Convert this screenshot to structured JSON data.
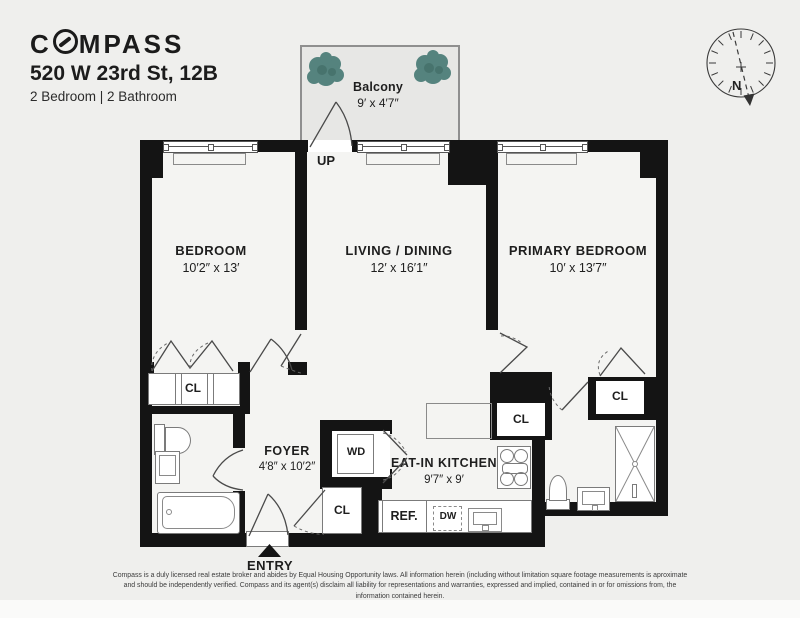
{
  "header": {
    "logo_c": "C",
    "logo_rest": "MPASS",
    "address": "520 W 23rd St, 12B",
    "subtitle": "2 Bedroom | 2 Bathroom"
  },
  "compass_rose": {
    "north_label": "N"
  },
  "rooms": {
    "balcony": {
      "name": "Balcony",
      "dims": "9′ x 4′7″"
    },
    "bedroom": {
      "name": "BEDROOM",
      "dims": "10′2″ x 13′"
    },
    "living": {
      "name": "LIVING / DINING",
      "dims": "12′ x 16′1″"
    },
    "primary": {
      "name": "PRIMARY BEDROOM",
      "dims": "10′ x 13′7″"
    },
    "foyer": {
      "name": "FOYER",
      "dims": "4′8″ x 10′2″"
    },
    "kitchen": {
      "name": "EAT-IN KITCHEN",
      "dims": "9′7″ x 9′"
    }
  },
  "labels": {
    "up": "UP",
    "entry": "ENTRY",
    "closet": "CL",
    "washer_dryer": "WD",
    "refrigerator": "REF.",
    "dishwasher": "DW"
  },
  "colors": {
    "wall": "#141414",
    "plant": "#55837e",
    "background": "#efefed"
  },
  "footer": {
    "disclaimer": "Compass is a duly licensed real estate broker and abides by Equal Housing Opportunity laws. All information herein (including without limitation square footage measurements is aproximate and should be independently verified. Compass and its agent(s) disclaim all liability for representations and warranties, expressed and implied, contained in or for omissions from, the information contained herein."
  }
}
